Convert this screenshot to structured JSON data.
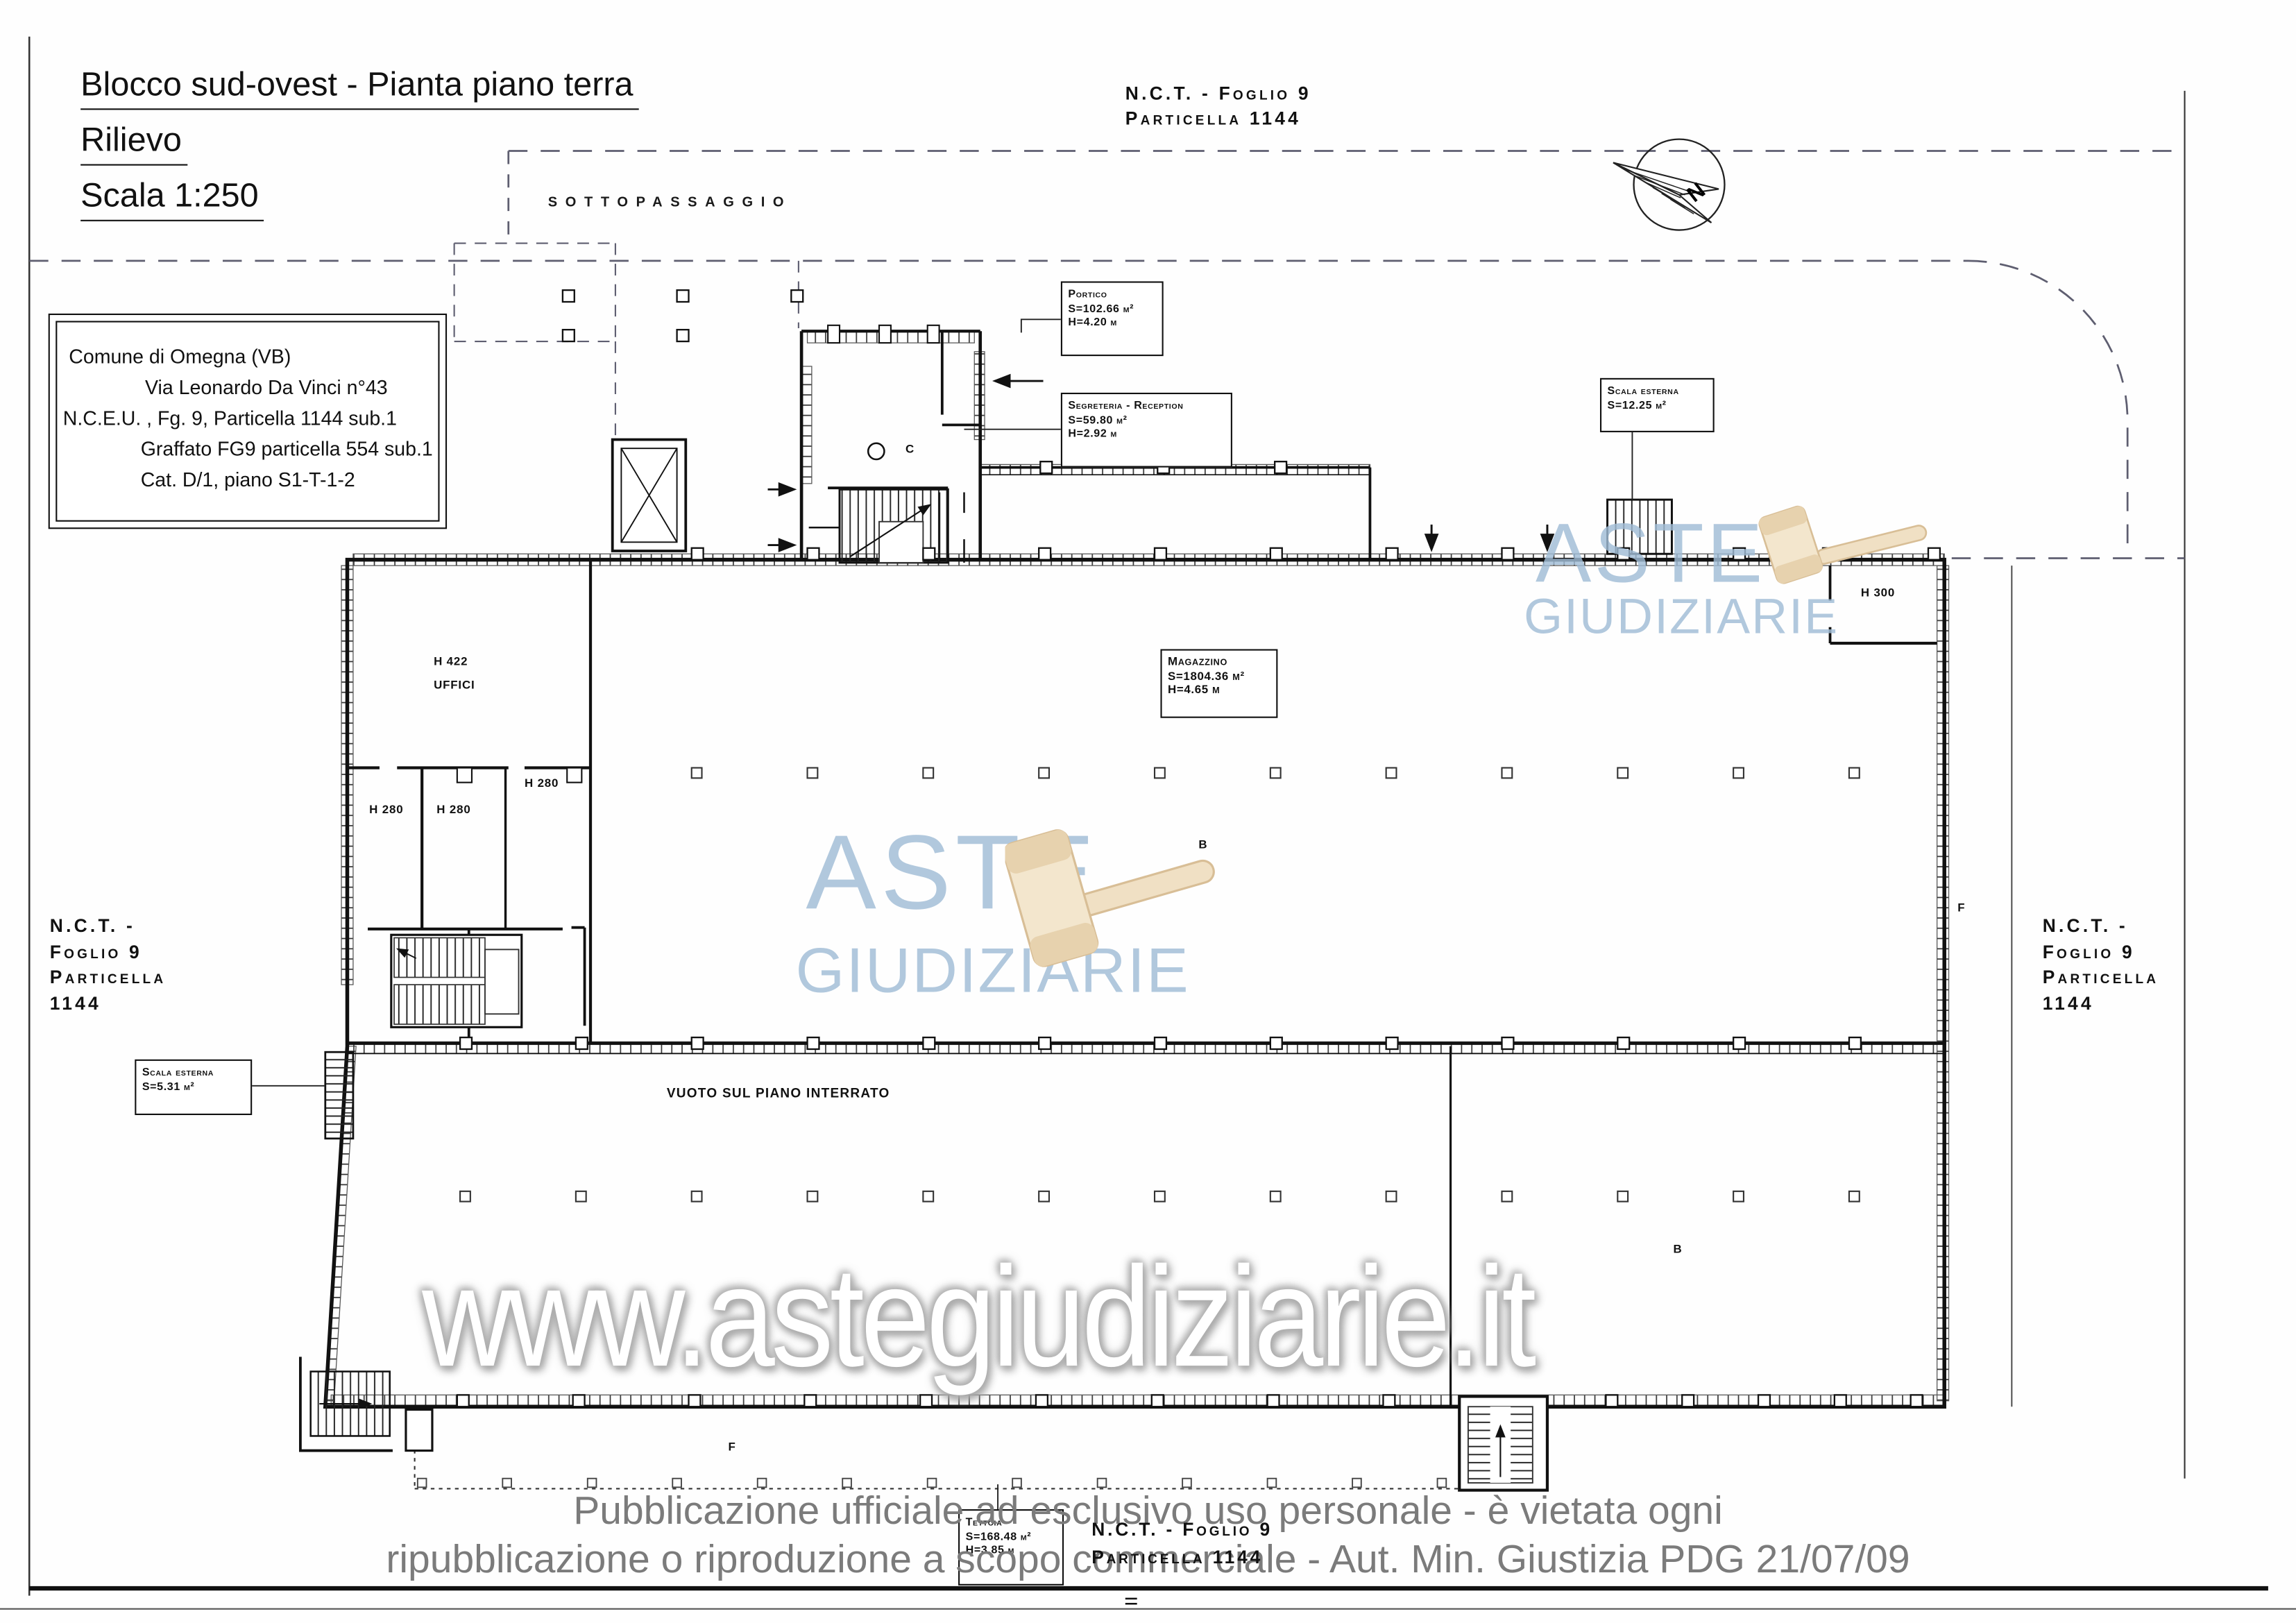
{
  "title_block": {
    "line1": "Blocco sud-ovest - Pianta piano terra",
    "line2": "Rilievo",
    "line3": "Scala 1:250"
  },
  "nct_top": {
    "line1": "N.C.T. - Foglio 9",
    "line2": "Particella  1144"
  },
  "nct_left": {
    "line1": "N.C.T. -",
    "line2": "Foglio 9",
    "line3": "Particella",
    "line4": "1144"
  },
  "nct_right": {
    "line1": "N.C.T. -",
    "line2": "Foglio 9",
    "line3": "Particella",
    "line4": "1144"
  },
  "nct_bottom": {
    "line1": "N.C.T. - Foglio 9",
    "line2": "Particella 1144"
  },
  "sottopassaggio": "SOTTOPASSAGGIO",
  "info_box": {
    "line1": "Comune di Omegna (VB)",
    "line2": "Via Leonardo Da Vinci n°43",
    "line3": "N.C.E.U. , Fg. 9,  Particella 1144 sub.1",
    "line4": "Graffato FG9 particella 554 sub.1",
    "line5": "Cat. D/1, piano S1-T-1-2"
  },
  "annotations": {
    "portico": {
      "title": "Portico",
      "area": "S=102.66 m²",
      "height": "H=4.20 m"
    },
    "segreteria": {
      "title": "Segreteria - Reception",
      "area": "S=59.80 m²",
      "height": "H=2.92 m"
    },
    "scala_esterna_destra": {
      "title": "Scala esterna",
      "area": "S=12.25 m²"
    },
    "magazzino": {
      "title": "Magazzino",
      "area": "S=1804.36 m²",
      "height": "H=4.65 m"
    },
    "scala_esterna_sinistra": {
      "title": "Scala esterna",
      "area": "S=5.31 m²"
    },
    "tettoia": {
      "title": "Tettoia",
      "area": "S=168.48 m²",
      "height": "H=3.85 m"
    }
  },
  "room_labels": {
    "uffici_altezza": "H 422",
    "uffici": "UFFICI",
    "h280_a": "H 280",
    "h280_b": "H 280",
    "h280_c": "H 280",
    "h300": "H 300",
    "b_magazzino": "B",
    "b_interrato": "B",
    "c_reception": "C",
    "f_destra": "F",
    "f_tettoia": "F",
    "vuoto": "VUOTO SUL PIANO INTERRATO"
  },
  "compass": {
    "label": "N"
  },
  "watermarks": {
    "aste": "ASTE",
    "giudiziarie": "GIUDIZIARIE",
    "url": "www.astegiudiziarie.it",
    "color_blue": "#a0bcd6",
    "color_gavel": "#eedcbc"
  },
  "disclaimer": {
    "line1": "Pubblicazione ufficiale ad esclusivo uso personale - è vietata ogni",
    "line2": "ripubblicazione o riproduzione a scopo commerciale - Aut. Min. Giustizia PDG 21/07/09"
  }
}
